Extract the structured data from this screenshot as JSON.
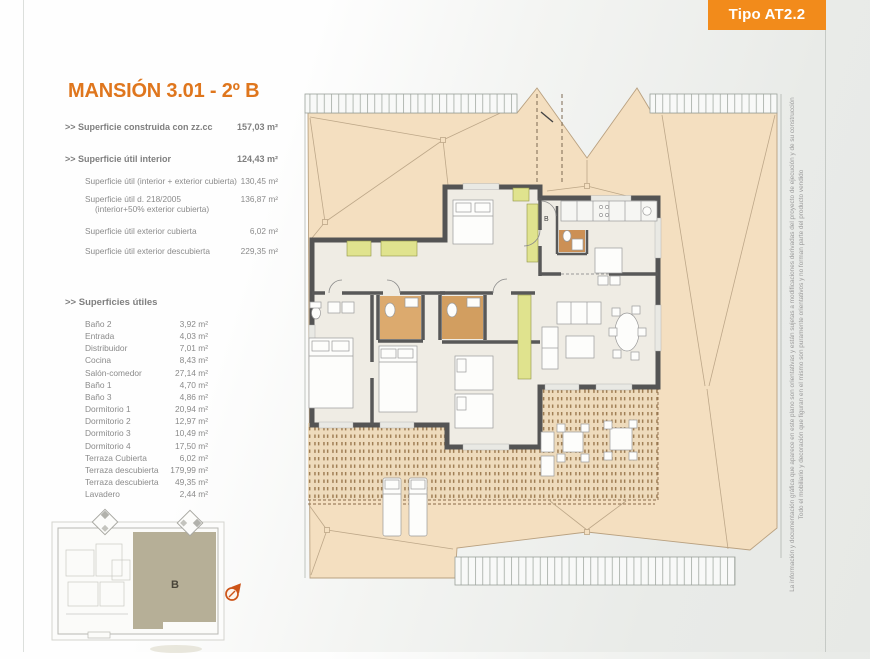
{
  "badge": {
    "label": "Tipo AT2.2",
    "color": "#f28b1b"
  },
  "plan": {
    "title": "MANSIÓN 3.01 - 2º B",
    "unit_label": "B",
    "entrance_label": "B"
  },
  "summary": {
    "r1": {
      "label": ">> Superficie construida con zz.cc",
      "value": "157,03 m²"
    },
    "r2": {
      "label": ">> Superficie útil interior",
      "value": "124,43 m²"
    },
    "r3": {
      "label": "Superficie útil (interior + exterior cubierta)",
      "value": "130,45 m²"
    },
    "r4": {
      "label": "Superficie útil  d. 218/2005",
      "label2": "(interior+50% exterior cubierta)",
      "value": "136,87 m²"
    },
    "r5": {
      "label": "Superficie útil exterior cubierta",
      "value": "6,02 m²"
    },
    "r6": {
      "label": "Superficie útil exterior descubierta",
      "value": "229,35 m²"
    }
  },
  "rooms": {
    "heading": ">> Superficies útiles",
    "items": [
      {
        "name": "Baño 2",
        "value": "3,92 m²"
      },
      {
        "name": "Entrada",
        "value": "4,03 m²"
      },
      {
        "name": "Distribuidor",
        "value": "7,01 m²"
      },
      {
        "name": "Cocina",
        "value": "8,43 m²"
      },
      {
        "name": "Salón-comedor",
        "value": "27,14 m²"
      },
      {
        "name": "Baño 1",
        "value": "4,70 m²"
      },
      {
        "name": "Baño 3",
        "value": "4,86 m²"
      },
      {
        "name": "Dormitorio 1",
        "value": "20,94 m²"
      },
      {
        "name": "Dormitorio 2",
        "value": "12,97 m²"
      },
      {
        "name": "Dormitorio 3",
        "value": "10,49 m²"
      },
      {
        "name": "Dormitorio 4",
        "value": "17,50 m²"
      },
      {
        "name": "Terraza Cubierta",
        "value": "6,02 m²"
      },
      {
        "name": "Terraza descubierta",
        "value": "179,99 m²"
      },
      {
        "name": "Terraza descubierta",
        "value": "49,35 m²"
      },
      {
        "name": "Lavadero",
        "value": "2,44 m²"
      }
    ]
  },
  "disclaimer": {
    "line1": "La información y documentación gráfica que aparece en este plano son orientativas y están sujetas a modificaciones derivadas del proyecto de ejecución y de su construcción",
    "line2": "Todo el mobiliario y decoración que figuran en el mismo son puramente orientativos y no forman parte del producto vendido"
  },
  "colors": {
    "accent_orange": "#f28b1b",
    "title_orange": "#df761d",
    "roof_tan": "#f4dfc0",
    "wall_gray": "#545454",
    "wardrobe_yellow": "#e0e38e",
    "bath_tan": "#dcaa6e",
    "keyplan_olive": "#b6af97"
  }
}
